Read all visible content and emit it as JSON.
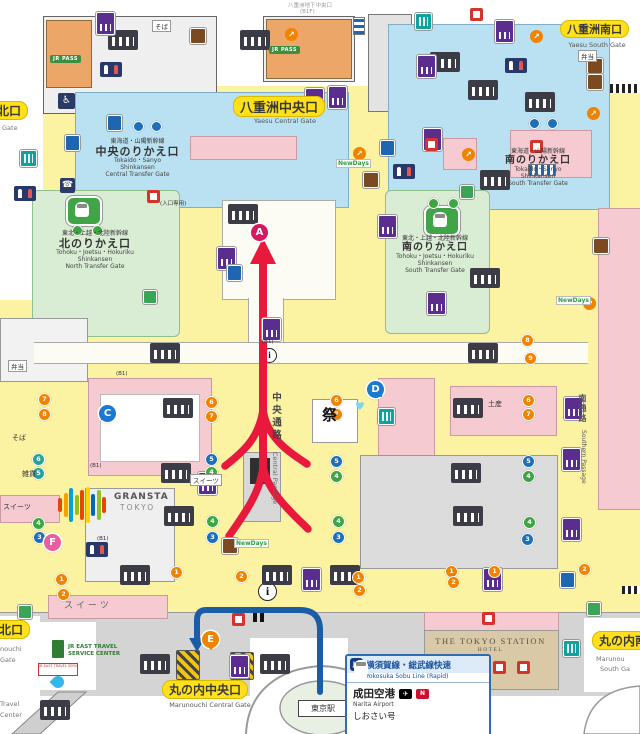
{
  "top_note": {
    "l1": "八重洲地下中央口",
    "l2": "(B1F)"
  },
  "gates": {
    "yaesu_central": {
      "jp": "八重洲中央口",
      "en": "Yaesu Central Gate"
    },
    "yaesu_south": {
      "jp": "八重洲南口",
      "en": "Yaesu South Gate"
    },
    "yaesu_north": {
      "jp": "北口",
      "en": "Gate"
    },
    "marunouchi_central": {
      "jp": "丸の内中央口",
      "en": "Marunouchi Central Gate"
    },
    "marunouchi_north": {
      "jp": "北口",
      "en1": "nouchi",
      "en2": "Gate"
    },
    "marunouchi_south": {
      "jp": "丸の内南口",
      "en1": "Marunou",
      "en2": "South Ga"
    }
  },
  "transfer_gates": {
    "tokaido_central": {
      "line": "東海道・山陽新幹線",
      "name": "中央のりかえ口",
      "en1": "Tokaido・Sanyo",
      "en2": "Shinkansen",
      "en3": "Central Transfer Gate"
    },
    "tokaido_south": {
      "line": "東海道・山陽新幹線",
      "name": "南のりかえ口",
      "en1": "Tokaido・Sanyo",
      "en2": "Shinkansen",
      "en3": "South Transfer Gate"
    },
    "tohoku_north": {
      "line": "東北・上越・北陸新幹線",
      "name": "北のりかえ口",
      "en1": "Tohoku・Joetsu・Hokuriku",
      "en2": "Shinkansen",
      "en3": "North Transfer Gate"
    },
    "tohoku_south": {
      "line": "東北・上越・北陸新幹線",
      "name": "南のりかえ口",
      "en1": "Tohoku・Joetsu・Hokuriku",
      "en2": "Shinkansen",
      "en3": "South Transfer Gate"
    }
  },
  "passages": {
    "central": {
      "jp": "中央通路",
      "en": "Central Passage"
    },
    "southern": {
      "jp": "南通路",
      "en": "Southern Passage"
    }
  },
  "station": {
    "dome_label": "東京駅"
  },
  "hotel": {
    "name": "THE TOKYO STATION",
    "sub": "HOTEL"
  },
  "gransta": {
    "l1": "GRANSTA",
    "l2": "TOKYO"
  },
  "jr_pass": "JR PASS",
  "travel_center": {
    "l1": "JR EAST TRAVEL",
    "l2": "SERVICE CENTER",
    "logo": "JR-EAST TRAVEL SERVICE CENTER",
    "side1": "Travel",
    "side2": "Center"
  },
  "info_box": {
    "badge": "JO",
    "line_jp": "横須賀線・総武線快速",
    "line_en": "Yokosuka Sobu Line (Rapid)",
    "dest_jp": "成田空港",
    "dest_en": "Narita Airport",
    "plane_icon": "✈",
    "nex_icon": "N",
    "train": "しおさい号"
  },
  "info_icon_glyph": "i",
  "heart_icon_glyph": "♥",
  "wheelchair_glyph": "♿",
  "phone_glyph": "☎",
  "markers": [
    {
      "t": "A",
      "x": 251,
      "y": 224,
      "c": "#D6185E",
      "cls": "m-plain"
    },
    {
      "t": "C",
      "x": 99,
      "y": 405,
      "c": "#1B79D2",
      "cls": "m-tail-l"
    },
    {
      "t": "D",
      "x": 367,
      "y": 381,
      "c": "#1B79D2",
      "cls": "m-tail-r"
    },
    {
      "t": "E",
      "x": 202,
      "y": 631,
      "c": "#F08300",
      "cls": "m-tail-d"
    },
    {
      "t": "F",
      "x": 44,
      "y": 534,
      "c": "#EA5EA0",
      "cls": "m-plain"
    }
  ],
  "labels": [
    {
      "t": "そば",
      "x": 152,
      "y": 20,
      "cls": "tag"
    },
    {
      "t": "そば",
      "x": 12,
      "y": 433,
      "cls": "plain"
    },
    {
      "t": "雑貨",
      "x": 22,
      "y": 469,
      "cls": "plain"
    },
    {
      "t": "スイーツ",
      "x": 3,
      "y": 502,
      "cls": "plain"
    },
    {
      "t": "スイーツ",
      "x": 190,
      "y": 474,
      "cls": "tag"
    },
    {
      "t": "スイーツ",
      "x": 64,
      "y": 598,
      "cls": "pinkbig"
    },
    {
      "t": "弁当",
      "x": 8,
      "y": 360,
      "cls": "tag"
    },
    {
      "t": "弁当",
      "x": 578,
      "y": 50,
      "cls": "tag"
    },
    {
      "t": "土産",
      "x": 488,
      "y": 399,
      "cls": "plain"
    },
    {
      "t": "祭",
      "x": 322,
      "y": 404,
      "cls": "matsuri"
    },
    {
      "t": "(入口専用)",
      "x": 160,
      "y": 199,
      "cls": "b1"
    },
    {
      "t": "(B1)",
      "x": 116,
      "y": 371,
      "cls": "b1"
    },
    {
      "t": "(B1)",
      "x": 262,
      "y": 339,
      "cls": "b1"
    },
    {
      "t": "(B1)",
      "x": 90,
      "y": 463,
      "cls": "b1"
    },
    {
      "t": "(B1)",
      "x": 97,
      "y": 536,
      "cls": "b1"
    },
    {
      "t": "NewDays",
      "x": 336,
      "y": 159,
      "cls": "nd"
    },
    {
      "t": "NewDays",
      "x": 556,
      "y": 296,
      "cls": "nd"
    },
    {
      "t": "NewDays",
      "x": 234,
      "y": 539,
      "cls": "nd"
    }
  ],
  "icons": {
    "stairs": [
      {
        "x": 108,
        "y": 30
      },
      {
        "x": 240,
        "y": 30
      },
      {
        "x": 430,
        "y": 52
      },
      {
        "x": 468,
        "y": 80
      },
      {
        "x": 525,
        "y": 92
      },
      {
        "x": 228,
        "y": 204
      },
      {
        "x": 480,
        "y": 170
      },
      {
        "x": 470,
        "y": 268
      },
      {
        "x": 150,
        "y": 343
      },
      {
        "x": 468,
        "y": 343
      },
      {
        "x": 163,
        "y": 398
      },
      {
        "x": 161,
        "y": 463
      },
      {
        "x": 164,
        "y": 506
      },
      {
        "x": 453,
        "y": 398
      },
      {
        "x": 451,
        "y": 463
      },
      {
        "x": 453,
        "y": 506
      },
      {
        "x": 120,
        "y": 565
      },
      {
        "x": 262,
        "y": 565
      },
      {
        "x": 330,
        "y": 565
      },
      {
        "x": 140,
        "y": 654
      },
      {
        "x": 260,
        "y": 654
      },
      {
        "x": 40,
        "y": 700
      }
    ],
    "purple_boxes": [
      {
        "x": 96,
        "y": 12
      },
      {
        "x": 305,
        "y": 88
      },
      {
        "x": 328,
        "y": 86
      },
      {
        "x": 417,
        "y": 55
      },
      {
        "x": 423,
        "y": 128
      },
      {
        "x": 495,
        "y": 20
      },
      {
        "x": 378,
        "y": 215
      },
      {
        "x": 427,
        "y": 292
      },
      {
        "x": 217,
        "y": 247
      },
      {
        "x": 262,
        "y": 318
      },
      {
        "x": 564,
        "y": 397
      },
      {
        "x": 562,
        "y": 448
      },
      {
        "x": 562,
        "y": 518
      },
      {
        "x": 198,
        "y": 472
      },
      {
        "x": 483,
        "y": 568
      },
      {
        "x": 230,
        "y": 655
      },
      {
        "x": 302,
        "y": 568
      }
    ],
    "teal_boxes": [
      {
        "x": 20,
        "y": 150
      },
      {
        "x": 415,
        "y": 13
      },
      {
        "x": 378,
        "y": 408
      },
      {
        "x": 563,
        "y": 640
      }
    ],
    "blue_boxes": [
      {
        "x": 65,
        "y": 135
      },
      {
        "x": 107,
        "y": 115
      },
      {
        "x": 227,
        "y": 265
      },
      {
        "x": 560,
        "y": 572
      },
      {
        "x": 380,
        "y": 140
      }
    ],
    "brown_boxes": [
      {
        "x": 190,
        "y": 28
      },
      {
        "x": 222,
        "y": 538
      },
      {
        "x": 363,
        "y": 172
      },
      {
        "x": 587,
        "y": 58
      },
      {
        "x": 587,
        "y": 74
      },
      {
        "x": 593,
        "y": 238
      }
    ],
    "red_boxes": [
      {
        "x": 147,
        "y": 190
      },
      {
        "x": 425,
        "y": 138
      },
      {
        "x": 470,
        "y": 8
      },
      {
        "x": 530,
        "y": 140
      },
      {
        "x": 482,
        "y": 612
      },
      {
        "x": 232,
        "y": 613
      },
      {
        "x": 493,
        "y": 661
      },
      {
        "x": 517,
        "y": 661
      }
    ],
    "green_squares": [
      {
        "x": 143,
        "y": 290
      },
      {
        "x": 460,
        "y": 185
      },
      {
        "x": 18,
        "y": 605
      },
      {
        "x": 587,
        "y": 602
      }
    ],
    "orange_arrows": [
      {
        "x": 353,
        "y": 147
      },
      {
        "x": 462,
        "y": 148
      },
      {
        "x": 587,
        "y": 107
      },
      {
        "x": 583,
        "y": 297
      },
      {
        "x": 530,
        "y": 30
      },
      {
        "x": 285,
        "y": 28
      }
    ],
    "restrooms": [
      {
        "x": 100,
        "y": 62
      },
      {
        "x": 505,
        "y": 58
      },
      {
        "x": 393,
        "y": 164
      },
      {
        "x": 14,
        "y": 186
      },
      {
        "x": 86,
        "y": 542
      }
    ],
    "dots": [
      {
        "x": 205,
        "y": 396,
        "c": "#F08300",
        "n": "6"
      },
      {
        "x": 205,
        "y": 410,
        "c": "#F08300",
        "n": "7"
      },
      {
        "x": 330,
        "y": 394,
        "c": "#F08300",
        "n": "6"
      },
      {
        "x": 330,
        "y": 408,
        "c": "#F08300",
        "n": "7"
      },
      {
        "x": 38,
        "y": 393,
        "c": "#F08300",
        "n": "7"
      },
      {
        "x": 38,
        "y": 408,
        "c": "#F08300",
        "n": "8"
      },
      {
        "x": 522,
        "y": 394,
        "c": "#F08300",
        "n": "6"
      },
      {
        "x": 522,
        "y": 408,
        "c": "#F08300",
        "n": "7"
      },
      {
        "x": 521,
        "y": 334,
        "c": "#F08300",
        "n": "8"
      },
      {
        "x": 524,
        "y": 352,
        "c": "#F08300",
        "n": "9"
      },
      {
        "x": 205,
        "y": 453,
        "c": "#1C6FB8",
        "n": "5"
      },
      {
        "x": 206,
        "y": 531,
        "c": "#1C6FB8",
        "n": "3"
      },
      {
        "x": 330,
        "y": 455,
        "c": "#1C6FB8",
        "n": "5"
      },
      {
        "x": 332,
        "y": 531,
        "c": "#1C6FB8",
        "n": "3"
      },
      {
        "x": 33,
        "y": 531,
        "c": "#1C6FB8",
        "n": "3"
      },
      {
        "x": 522,
        "y": 455,
        "c": "#1C6FB8",
        "n": "5"
      },
      {
        "x": 521,
        "y": 533,
        "c": "#1C6FB8",
        "n": "3"
      },
      {
        "x": 205,
        "y": 466,
        "c": "#3DA643",
        "n": "4"
      },
      {
        "x": 206,
        "y": 515,
        "c": "#3DA643",
        "n": "4"
      },
      {
        "x": 330,
        "y": 470,
        "c": "#3DA643",
        "n": "4"
      },
      {
        "x": 332,
        "y": 515,
        "c": "#3DA643",
        "n": "4"
      },
      {
        "x": 32,
        "y": 517,
        "c": "#3DA643",
        "n": "4"
      },
      {
        "x": 522,
        "y": 470,
        "c": "#3DA643",
        "n": "4"
      },
      {
        "x": 523,
        "y": 516,
        "c": "#3DA643",
        "n": "4"
      },
      {
        "x": 32,
        "y": 453,
        "c": "#2AA198",
        "n": "6"
      },
      {
        "x": 32,
        "y": 467,
        "c": "#2AA198",
        "n": "5"
      },
      {
        "x": 55,
        "y": 573,
        "c": "#F08300",
        "n": "1"
      },
      {
        "x": 57,
        "y": 588,
        "c": "#F08300",
        "n": "2"
      },
      {
        "x": 170,
        "y": 566,
        "c": "#F08300",
        "n": "1"
      },
      {
        "x": 235,
        "y": 570,
        "c": "#F08300",
        "n": "2"
      },
      {
        "x": 352,
        "y": 571,
        "c": "#F08300",
        "n": "1"
      },
      {
        "x": 353,
        "y": 584,
        "c": "#F08300",
        "n": "2"
      },
      {
        "x": 445,
        "y": 565,
        "c": "#F08300",
        "n": "1"
      },
      {
        "x": 447,
        "y": 576,
        "c": "#F08300",
        "n": "2"
      },
      {
        "x": 488,
        "y": 565,
        "c": "#F08300",
        "n": "1"
      },
      {
        "x": 578,
        "y": 563,
        "c": "#F08300",
        "n": "2"
      }
    ],
    "pair_dots": [
      {
        "x": 133,
        "y": 121,
        "c": "#1C6FB8"
      },
      {
        "x": 151,
        "y": 121,
        "c": "#1C6FB8"
      },
      {
        "x": 529,
        "y": 118,
        "c": "#1C6FB8"
      },
      {
        "x": 547,
        "y": 118,
        "c": "#1C6FB8"
      },
      {
        "x": 72,
        "y": 225,
        "c": "#3DA643"
      },
      {
        "x": 92,
        "y": 225,
        "c": "#3DA643"
      },
      {
        "x": 428,
        "y": 198,
        "c": "#3DA643"
      },
      {
        "x": 448,
        "y": 198,
        "c": "#3DA643"
      }
    ]
  }
}
